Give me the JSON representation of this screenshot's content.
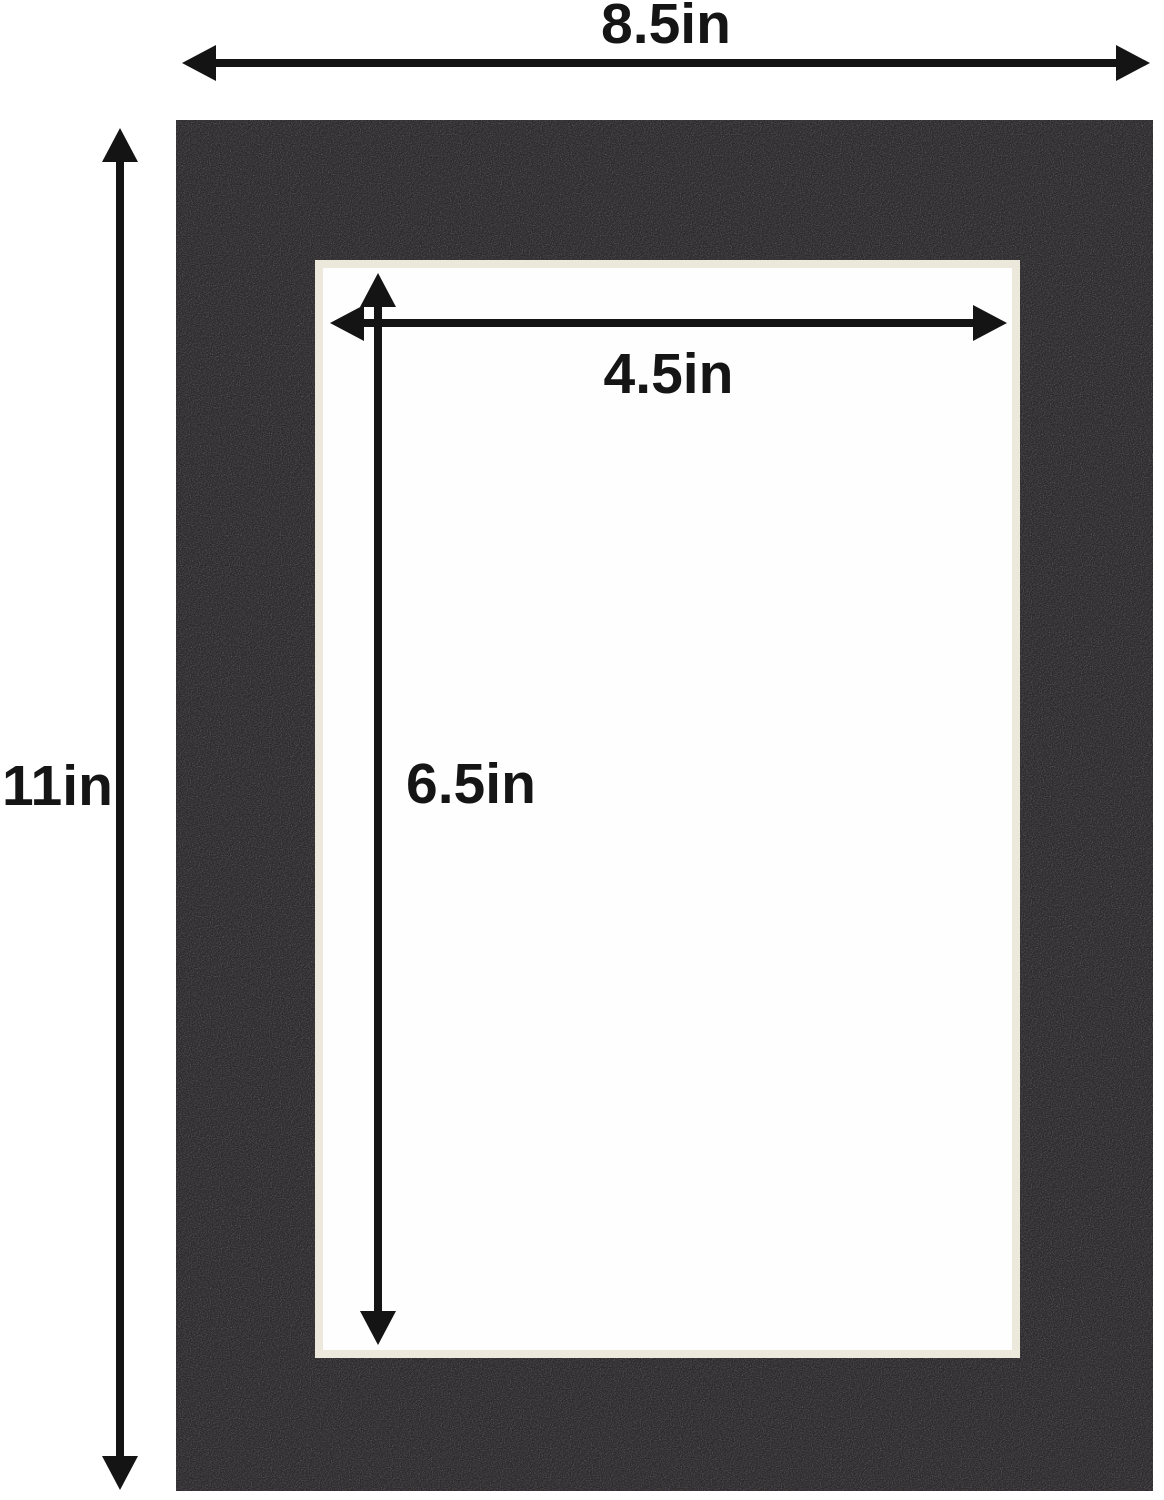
{
  "diagram": {
    "title": "mat-board-dimension-diagram",
    "outer_width_label": "8.5in",
    "outer_height_label": "11in",
    "opening_width_label": "4.5in",
    "opening_height_label": "6.5in"
  },
  "colors": {
    "background": "#ffffff",
    "mat": "#2c292c",
    "bevel": "#ece8db",
    "opening": "#fefefe",
    "arrow": "#141414",
    "text": "#151515"
  }
}
